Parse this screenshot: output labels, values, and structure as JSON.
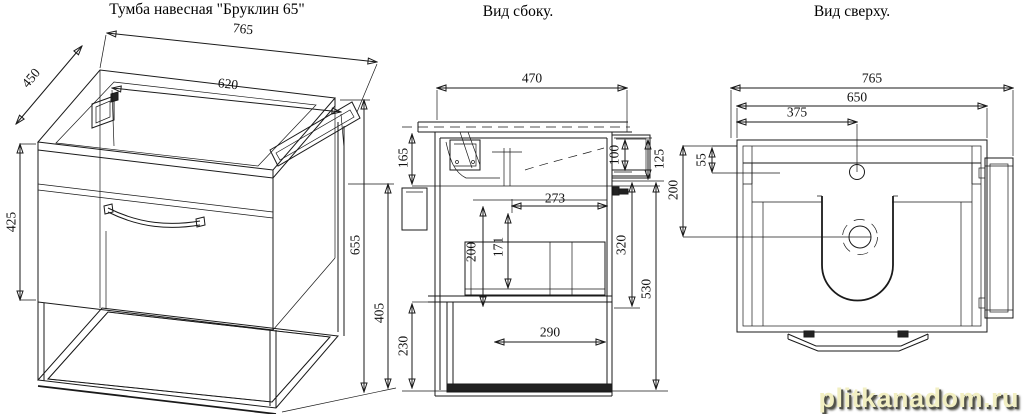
{
  "page": {
    "background": "#ffffff",
    "line_color": "#1a1a1a"
  },
  "watermark": {
    "text": "plitkanadom.ru",
    "color": "#f2efc2",
    "shadow_color": "#52524a"
  },
  "views": {
    "perspective": {
      "title": "Тумба навесная \"Бруклин 65\"",
      "dims": {
        "total_width": "765",
        "cabinet_width": "620",
        "depth": "450",
        "front_height": "425",
        "total_height": "655",
        "frame_height": "405"
      }
    },
    "side": {
      "title": "Вид сбоку.",
      "dims": {
        "depth": "470",
        "wall_bracket_offset": "165",
        "rail_top": "100",
        "rail_height": "125",
        "inner_depth": "273",
        "drawer_inner": "171",
        "inner_height": "200",
        "basin_to_bottom": "320",
        "body_height": "530",
        "drawer_depth": "290",
        "lower_section": "230"
      }
    },
    "top": {
      "title": "Вид сверху.",
      "dims": {
        "total_width": "765",
        "cabinet_width": "650",
        "faucet_offset": "375",
        "back_band": "55",
        "drain_offset": "200"
      }
    }
  }
}
